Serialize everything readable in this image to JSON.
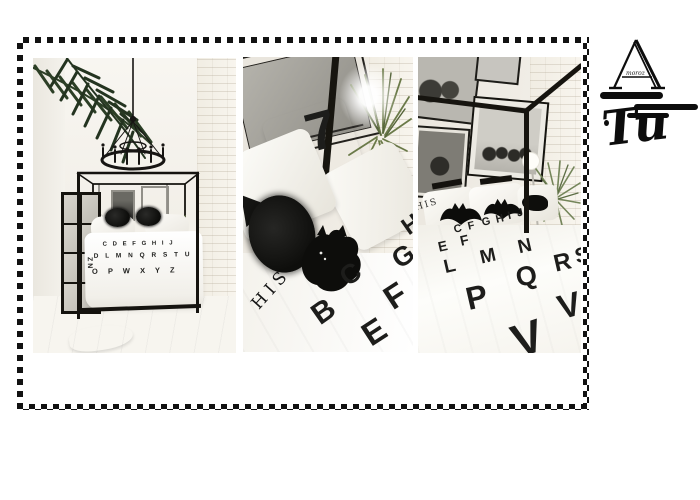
{
  "logo": {
    "monogram": "A",
    "sub_text": "moroz",
    "script_text": "Tu"
  },
  "photos": {
    "wide": {
      "duvet_rows": [
        "C D E F G H I J",
        "D L M N Q R S T U",
        "O P W X Y Z",
        "ZN"
      ]
    },
    "closeup": {
      "glyph": "7",
      "his_text": "HIS",
      "letters": [
        "B",
        "C",
        "E",
        "F",
        "G",
        "H"
      ]
    },
    "perspective": {
      "his_text": "HIS",
      "rows": [
        [
          "C",
          "F",
          "G",
          "H",
          "I",
          "J"
        ],
        [
          "E",
          "F"
        ],
        [
          "L",
          "M",
          "N"
        ],
        [
          "P",
          "Q",
          "R",
          "S"
        ],
        [
          "V",
          "V"
        ]
      ]
    }
  }
}
